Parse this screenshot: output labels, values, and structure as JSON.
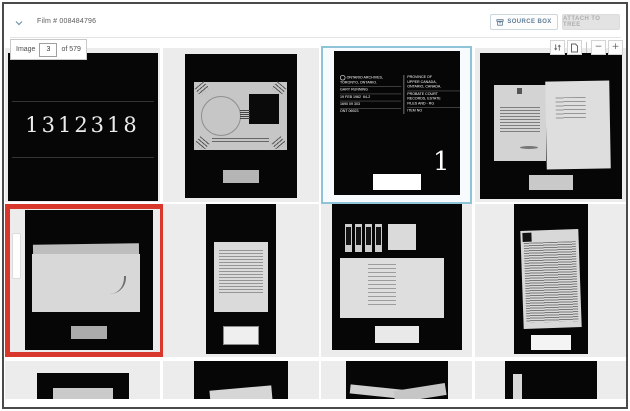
{
  "header": {
    "film_label": "Film # 008484796",
    "source_box_button": "SOURCE BOX",
    "attach_to_tree_button": "ATTACH TO TREE"
  },
  "toolbar": {
    "image_label": "Image",
    "image_number": "3",
    "of_total_label": "of 579",
    "zoom_out_label": "−",
    "zoom_in_label": "+"
  },
  "grid": {
    "film_number_frame": {
      "number": "1312318"
    },
    "title_card_frame": {
      "left_column": {
        "line1": "ONTARIO ARCHIVES,",
        "line2": "TORONTO, ONTARIO.",
        "operator": "GARY RUNNING",
        "date": "19 FEB 1962",
        "reduction": "64-2",
        "film_number": "1690 09 303",
        "unit": "ONT 06923"
      },
      "right_column": {
        "line1": "PROVINCE OF",
        "line2": "UPPER CANADA,",
        "line3": "ONTARIO, CANADA.",
        "line4": "PROBATE COURT",
        "line5": "RECORDS, ESTATE",
        "line6": "FILES AND - RG",
        "item_label": "ITEM NO",
        "item_number": "1"
      }
    }
  },
  "colors": {
    "selection_border": "#8fc3d8",
    "highlight_border": "#d8372b",
    "accent_blue": "#5f7d95"
  }
}
